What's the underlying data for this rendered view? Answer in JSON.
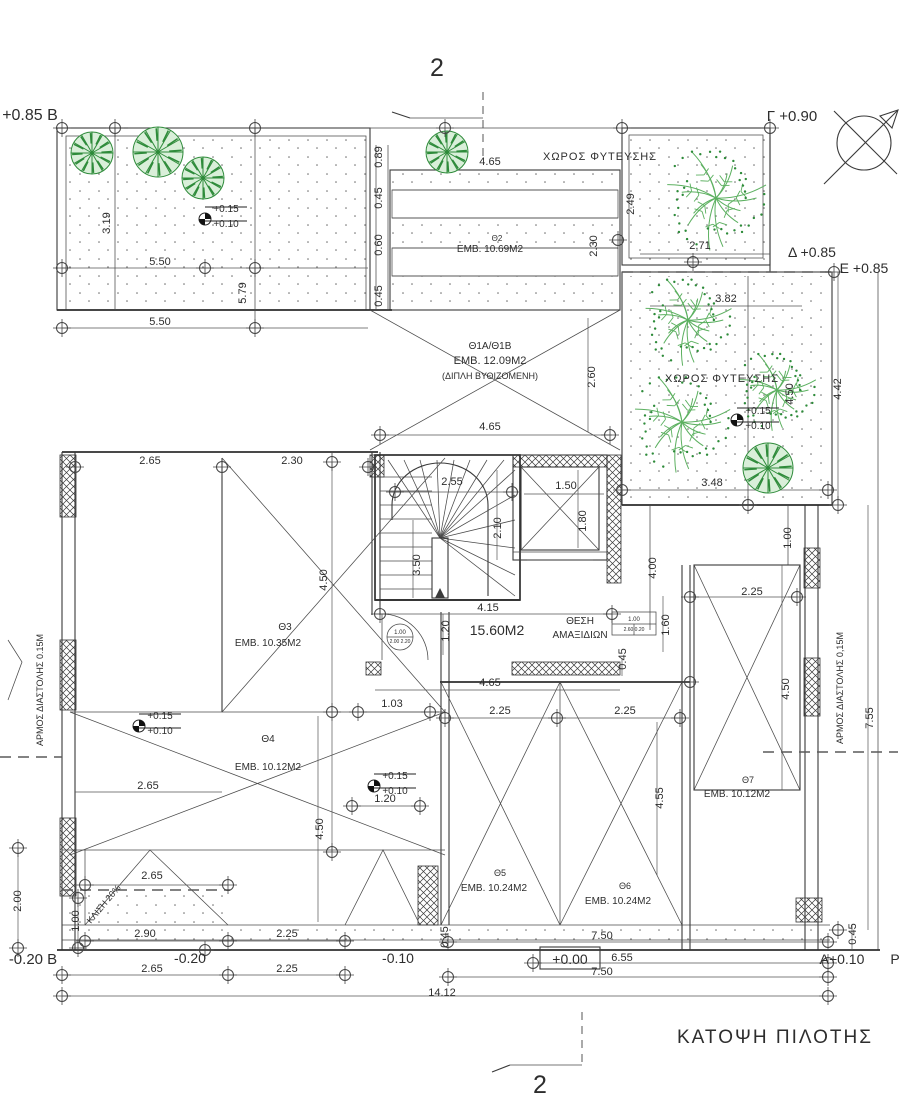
{
  "meta": {
    "drawing_title": "ΚΑΤΟΨΗ ΠΙΛΟΤΗΣ",
    "section_marker": "2",
    "colors": {
      "line": "#3a3a3a",
      "tree_dark": "#2e8b3a",
      "tree_light": "#5cb060",
      "tree_fill": "#d9efd9"
    }
  },
  "labels": [
    {
      "k": "level-label",
      "t": "+0.85 Β",
      "x": 30,
      "y": 120,
      "s": 16
    },
    {
      "k": "grid-point-label",
      "t": "Γ +0.90",
      "x": 792,
      "y": 121,
      "s": 15
    },
    {
      "k": "grid-point-label",
      "t": "Δ +0.85",
      "x": 812,
      "y": 257,
      "s": 14
    },
    {
      "k": "grid-point-label",
      "t": "Ε +0.85",
      "x": 864,
      "y": 273,
      "s": 14
    },
    {
      "k": "grid-point-label",
      "t": "Α+0.10",
      "x": 842,
      "y": 964,
      "s": 14
    },
    {
      "k": "grid-point-label",
      "t": "Ρ",
      "x": 895,
      "y": 964,
      "s": 14
    },
    {
      "k": "level-label",
      "t": "-0.20 Β",
      "x": 33,
      "y": 964,
      "s": 15
    },
    {
      "k": "level-label",
      "t": "-0.20",
      "x": 190,
      "y": 963,
      "s": 14
    },
    {
      "k": "level-label",
      "t": "-0.10",
      "x": 398,
      "y": 963,
      "s": 14
    },
    {
      "k": "level-label",
      "t": "+0.00",
      "x": 570,
      "y": 964,
      "s": 14
    },
    {
      "k": "section-number",
      "t": "2",
      "x": 437,
      "y": 76,
      "s": 25
    },
    {
      "k": "section-number",
      "t": "2",
      "x": 540,
      "y": 1093,
      "s": 25
    },
    {
      "k": "drawing-title",
      "t": "ΚΑΤΟΨΗ  ΠΙΛΟΤΗΣ",
      "x": 775,
      "y": 1043,
      "s": 19,
      "ls": 2
    },
    {
      "k": "area-label",
      "t": "ΧΩΡΟΣ  ΦΥΤΕΥΣΗΣ",
      "x": 600,
      "y": 160,
      "s": 11,
      "ls": 1
    },
    {
      "k": "area-label",
      "t": "ΧΩΡΟΣ  ΦΥΤΕΥΣΗΣ",
      "x": 722,
      "y": 382,
      "s": 11,
      "ls": 1
    },
    {
      "k": "space-id",
      "t": "Θ2",
      "x": 497,
      "y": 241,
      "s": 8
    },
    {
      "k": "space-area",
      "t": "ΕΜΒ. 10.69Μ2",
      "x": 490,
      "y": 252,
      "s": 10
    },
    {
      "k": "space-id",
      "t": "Θ1Α/Θ1Β",
      "x": 490,
      "y": 349,
      "s": 10
    },
    {
      "k": "space-area",
      "t": "ΕΜΒ. 12.09Μ2",
      "x": 490,
      "y": 364,
      "s": 11
    },
    {
      "k": "space-note",
      "t": "(ΔΙΠΛΗ ΒΥΘΙΖΟΜΕΝΗ)",
      "x": 490,
      "y": 379,
      "s": 9
    },
    {
      "k": "space-id",
      "t": "Θ3",
      "x": 285,
      "y": 630,
      "s": 10
    },
    {
      "k": "space-area",
      "t": "ΕΜΒ. 10.35Μ2",
      "x": 268,
      "y": 646,
      "s": 10
    },
    {
      "k": "space-id",
      "t": "Θ4",
      "x": 268,
      "y": 742,
      "s": 10
    },
    {
      "k": "space-area",
      "t": "ΕΜΒ. 10.12Μ2",
      "x": 268,
      "y": 770,
      "s": 10
    },
    {
      "k": "space-id",
      "t": "Θ5",
      "x": 500,
      "y": 876,
      "s": 9
    },
    {
      "k": "space-area",
      "t": "ΕΜΒ. 10.24Μ2",
      "x": 494,
      "y": 891,
      "s": 10
    },
    {
      "k": "space-id",
      "t": "Θ6",
      "x": 625,
      "y": 889,
      "s": 9
    },
    {
      "k": "space-area",
      "t": "ΕΜΒ. 10.24Μ2",
      "x": 618,
      "y": 904,
      "s": 10
    },
    {
      "k": "space-id",
      "t": "Θ7",
      "x": 748,
      "y": 783,
      "s": 9
    },
    {
      "k": "space-area",
      "t": "ΕΜΒ. 10.12Μ2",
      "x": 737,
      "y": 797,
      "s": 10
    },
    {
      "k": "space-area",
      "t": "15.60Μ2",
      "x": 497,
      "y": 635,
      "s": 14
    },
    {
      "k": "space-label",
      "t": "ΘΕΣΗ",
      "x": 580,
      "y": 624,
      "s": 10
    },
    {
      "k": "space-label",
      "t": "ΑΜΑΞΙΔΙΩΝ",
      "x": 580,
      "y": 638,
      "s": 10
    },
    {
      "k": "ramp-label",
      "t": "ΚΛΙΣΗ 20%",
      "x": 106,
      "y": 906,
      "s": 9,
      "r": -50
    },
    {
      "k": "joint-label",
      "t": "ΑΡΜΟΣ  ΔΙΑΣΤΟΛΗΣ  0.15Μ",
      "x": 43,
      "y": 690,
      "s": 9,
      "r": -90
    },
    {
      "k": "joint-label",
      "t": "ΑΡΜΟΣ  ΔΙΑΣΤΟΛΗΣ  0,15Μ",
      "x": 843,
      "y": 688,
      "s": 9,
      "r": -90
    },
    {
      "k": "level-label",
      "t": "+0.15",
      "x": 226,
      "y": 212,
      "s": 10
    },
    {
      "k": "level-label",
      "t": "+0.10",
      "x": 226,
      "y": 227,
      "s": 10
    },
    {
      "k": "level-label",
      "t": "+0.15",
      "x": 758,
      "y": 414,
      "s": 10
    },
    {
      "k": "level-label",
      "t": "+0.10",
      "x": 758,
      "y": 429,
      "s": 10
    },
    {
      "k": "level-label",
      "t": "+0.15",
      "x": 160,
      "y": 719,
      "s": 10
    },
    {
      "k": "level-label",
      "t": "+0.10",
      "x": 160,
      "y": 734,
      "s": 10
    },
    {
      "k": "level-label",
      "t": "+0.15",
      "x": 395,
      "y": 779,
      "s": 10
    },
    {
      "k": "level-label",
      "t": "+0.10",
      "x": 395,
      "y": 794,
      "s": 10
    },
    {
      "k": "door-tag",
      "t": "1.00",
      "x": 400,
      "y": 634,
      "s": 6
    },
    {
      "k": "door-tag",
      "t": "2.00 2.20",
      "x": 400,
      "y": 643,
      "s": 5
    },
    {
      "k": "opening-tag",
      "t": "1.00",
      "x": 634,
      "y": 621,
      "s": 6
    },
    {
      "k": "opening-tag",
      "t": "2.60 0.20",
      "x": 634,
      "y": 631,
      "s": 5
    },
    {
      "k": "dim",
      "t": "0.89",
      "x": 382,
      "y": 157,
      "r": -90
    },
    {
      "k": "dim",
      "t": "0.45",
      "x": 382,
      "y": 198,
      "r": -90
    },
    {
      "k": "dim",
      "t": "0.60",
      "x": 382,
      "y": 245,
      "r": -90
    },
    {
      "k": "dim",
      "t": "0.45",
      "x": 382,
      "y": 296,
      "r": -90
    },
    {
      "k": "dim",
      "t": "4.65",
      "x": 490,
      "y": 165
    },
    {
      "k": "dim",
      "t": "2.49",
      "x": 634,
      "y": 204,
      "r": -90
    },
    {
      "k": "dim",
      "t": "2.30",
      "x": 597,
      "y": 246,
      "r": -90
    },
    {
      "k": "dim",
      "t": "3.19",
      "x": 110,
      "y": 223,
      "r": -90
    },
    {
      "k": "dim",
      "t": "5.50",
      "x": 160,
      "y": 265
    },
    {
      "k": "dim",
      "t": "5.50",
      "x": 160,
      "y": 325
    },
    {
      "k": "dim",
      "t": "5.79",
      "x": 246,
      "y": 293,
      "r": -90
    },
    {
      "k": "dim",
      "t": "2.71",
      "x": 700,
      "y": 249
    },
    {
      "k": "dim",
      "t": "3.82",
      "x": 726,
      "y": 302
    },
    {
      "k": "dim",
      "t": "2.60",
      "x": 595,
      "y": 377,
      "r": -90
    },
    {
      "k": "dim",
      "t": "4.65",
      "x": 490,
      "y": 430
    },
    {
      "k": "dim",
      "t": "4.42",
      "x": 841,
      "y": 389,
      "r": -90
    },
    {
      "k": "dim",
      "t": "4.50",
      "x": 793,
      "y": 394,
      "r": -90
    },
    {
      "k": "dim",
      "t": "3.48",
      "x": 712,
      "y": 486
    },
    {
      "k": "dim",
      "t": "1.00",
      "x": 791,
      "y": 538,
      "r": -90
    },
    {
      "k": "dim",
      "t": "2.65",
      "x": 150,
      "y": 464
    },
    {
      "k": "dim",
      "t": "2.30",
      "x": 292,
      "y": 464
    },
    {
      "k": "dim",
      "t": "2.55",
      "x": 452,
      "y": 485
    },
    {
      "k": "dim",
      "t": "1.50",
      "x": 566,
      "y": 489
    },
    {
      "k": "dim",
      "t": "1.80",
      "x": 586,
      "y": 521,
      "r": -90
    },
    {
      "k": "dim",
      "t": "2.10",
      "x": 501,
      "y": 528,
      "r": -90
    },
    {
      "k": "dim",
      "t": "3.50",
      "x": 420,
      "y": 565,
      "r": -90
    },
    {
      "k": "dim",
      "t": "4.50",
      "x": 327,
      "y": 580,
      "r": -90
    },
    {
      "k": "dim",
      "t": "4.15",
      "x": 488,
      "y": 611
    },
    {
      "k": "dim",
      "t": "1.20",
      "x": 449,
      "y": 631,
      "r": -90
    },
    {
      "k": "dim",
      "t": "1.60",
      "x": 669,
      "y": 625,
      "r": -90
    },
    {
      "k": "dim",
      "t": "0.45",
      "x": 626,
      "y": 659,
      "r": -90
    },
    {
      "k": "dim",
      "t": "4.00",
      "x": 656,
      "y": 568,
      "r": -90
    },
    {
      "k": "dim",
      "t": "4.65",
      "x": 490,
      "y": 686
    },
    {
      "k": "dim",
      "t": "1.03",
      "x": 392,
      "y": 707
    },
    {
      "k": "dim",
      "t": "2.25",
      "x": 500,
      "y": 714
    },
    {
      "k": "dim",
      "t": "2.25",
      "x": 625,
      "y": 714
    },
    {
      "k": "dim",
      "t": "2.25",
      "x": 752,
      "y": 595
    },
    {
      "k": "dim",
      "t": "4.50",
      "x": 789,
      "y": 689,
      "r": -90
    },
    {
      "k": "dim",
      "t": "7.55",
      "x": 873,
      "y": 718,
      "r": -90
    },
    {
      "k": "dim",
      "t": "2.65",
      "x": 148,
      "y": 789
    },
    {
      "k": "dim",
      "t": "4.50",
      "x": 323,
      "y": 829,
      "r": -90
    },
    {
      "k": "dim",
      "t": "1.20",
      "x": 385,
      "y": 802
    },
    {
      "k": "dim",
      "t": "4.55",
      "x": 663,
      "y": 798,
      "r": -90
    },
    {
      "k": "dim",
      "t": "2.65",
      "x": 152,
      "y": 879
    },
    {
      "k": "dim",
      "t": "2.90",
      "x": 145,
      "y": 937
    },
    {
      "k": "dim",
      "t": "2.00",
      "x": 21,
      "y": 901,
      "r": -90
    },
    {
      "k": "dim",
      "t": "1.00",
      "x": 79,
      "y": 921,
      "r": -90
    },
    {
      "k": "dim",
      "t": "2.25",
      "x": 287,
      "y": 937
    },
    {
      "k": "dim",
      "t": "7.50",
      "x": 602,
      "y": 939
    },
    {
      "k": "dim",
      "t": "0.45",
      "x": 448,
      "y": 937,
      "r": -90
    },
    {
      "k": "dim",
      "t": "2.65",
      "x": 152,
      "y": 972
    },
    {
      "k": "dim",
      "t": "2.25",
      "x": 287,
      "y": 972
    },
    {
      "k": "dim",
      "t": "6.55",
      "x": 622,
      "y": 961
    },
    {
      "k": "dim",
      "t": "7.50",
      "x": 602,
      "y": 975
    },
    {
      "k": "dim",
      "t": "14.12",
      "x": 442,
      "y": 996
    },
    {
      "k": "dim",
      "t": "0.45",
      "x": 856,
      "y": 934,
      "r": -90
    }
  ]
}
